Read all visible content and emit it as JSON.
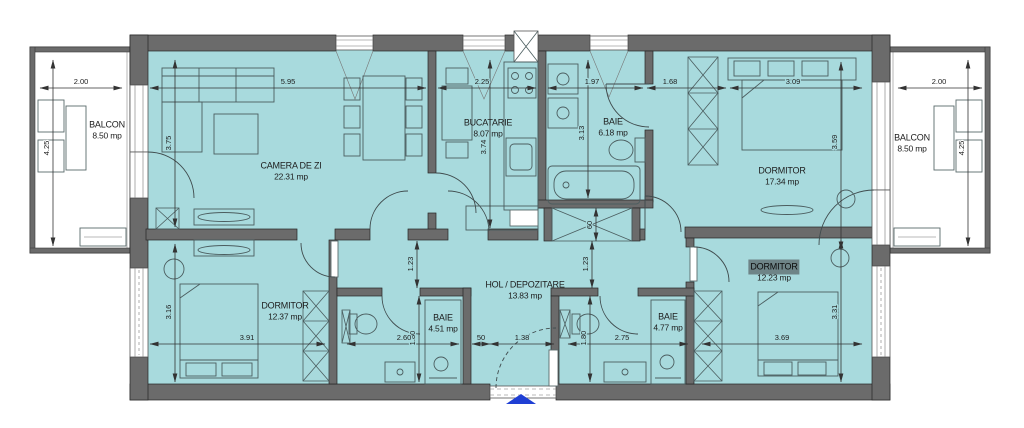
{
  "colors": {
    "floor_fill": "#a8dadd",
    "wall_fill": "#6b6b6b",
    "entry_arrow": "#1f3fd4",
    "selected_label_bg": "#6e8487"
  },
  "rooms": {
    "balcon_left": {
      "name": "BALCON",
      "area": "8.50 mp"
    },
    "camera_de_zi": {
      "name": "CAMERA DE ZI",
      "area": "22.31 mp"
    },
    "bucatarie": {
      "name": "BUCATARIE",
      "area": "8.07 mp"
    },
    "baie_top": {
      "name": "BAIE",
      "area": "6.18 mp"
    },
    "dormitor_top": {
      "name": "DORMITOR",
      "area": "17.34 mp"
    },
    "balcon_right": {
      "name": "BALCON",
      "area": "8.50 mp"
    },
    "dormitor_left": {
      "name": "DORMITOR",
      "area": "12.37 mp"
    },
    "hol": {
      "name": "HOL / DEPOZITARE",
      "area": "13.83 mp"
    },
    "baie_left": {
      "name": "BAIE",
      "area": "4.51 mp"
    },
    "baie_right": {
      "name": "BAIE",
      "area": "4.77 mp"
    },
    "dormitor_right": {
      "name": "DORMITOR",
      "area": "12.23 mp",
      "selected": true
    }
  },
  "dims": {
    "balcon_left_w": "2.00",
    "balcon_left_h": "4.25",
    "living_w": "5.95",
    "living_h": "3.75",
    "bucatarie_w": "2.25",
    "bucatarie_h": "3.74",
    "baie_top_w": "1.97",
    "baie_top_h": "3.13",
    "nisa_w": "1.68",
    "dormitor_top_w": "3.09",
    "dormitor_top_h": "3.59",
    "balcon_right_w": "2.00",
    "balcon_right_h": "4.25",
    "hol_left_h": "1.23",
    "hol_right_h": "1.23",
    "depozitare_d": "60",
    "dormitor_left_h": "3.16",
    "dormitor_left_w": "3.91",
    "baie_left_w": "2.60",
    "baie_left_h": "1.80",
    "intrare_a": "50",
    "intrare_b": "1.38",
    "baie_right_w": "2.75",
    "baie_right_h": "1.80",
    "dormitor_right_w": "3.69",
    "dormitor_right_h": "3.31"
  }
}
